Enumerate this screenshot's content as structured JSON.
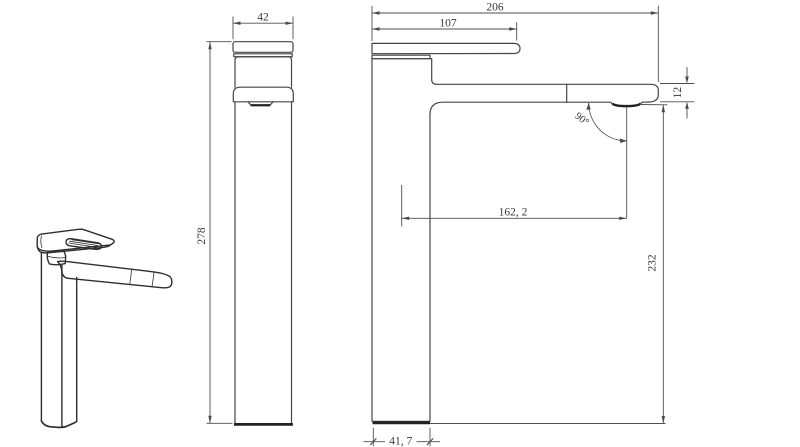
{
  "colors": {
    "background": "#ffffff",
    "outline": "#454545",
    "heavy_line": "#222222",
    "dimension_line": "#4f4f4f",
    "text": "#3a3a3a"
  },
  "dimensions": {
    "front_view": {
      "width": "42",
      "height": "278"
    },
    "side_view": {
      "overall_length": "206",
      "handle_length": "107",
      "spout_thickness": "12",
      "spout_angle": "90°",
      "spout_reach": "162, 2",
      "outlet_height": "232",
      "base_depth": "41, 7"
    }
  }
}
